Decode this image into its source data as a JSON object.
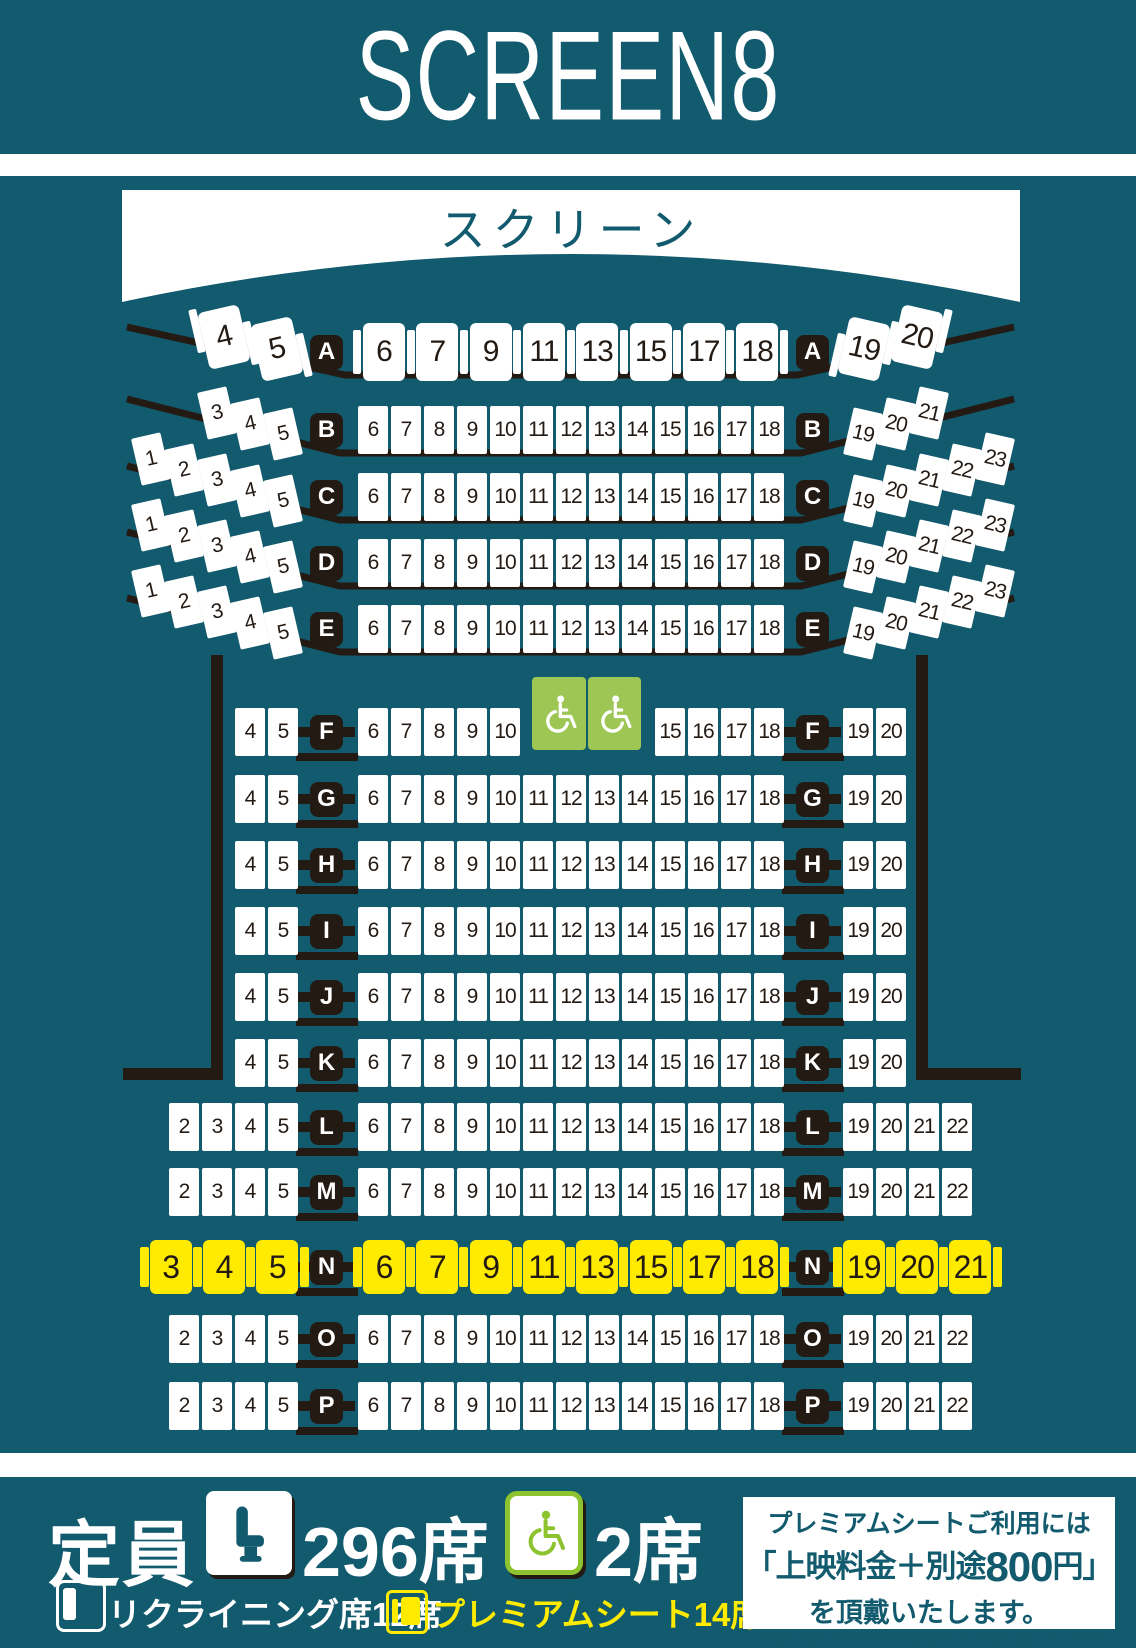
{
  "header": {
    "title": "SCREEN8"
  },
  "screen": {
    "label": "スクリーン"
  },
  "colors": {
    "background_teal": "#125a6d",
    "seat_white": "#ffffff",
    "ink_black": "#241a14",
    "premium_yellow": "#ffeb00",
    "wheelchair_green": "#9dc655",
    "legend_green": "#8cc32f"
  },
  "seatmap": {
    "rows": [
      {
        "label": "A",
        "kind": "recliner",
        "left": [
          "4",
          "5"
        ],
        "center": [
          "6",
          "7",
          "9",
          "11",
          "13",
          "15",
          "17",
          "18"
        ],
        "right": [
          "19",
          "20"
        ]
      },
      {
        "label": "B",
        "kind": "arc",
        "left": [
          "3",
          "4",
          "5"
        ],
        "center": [
          "6",
          "7",
          "8",
          "9",
          "10",
          "11",
          "12",
          "13",
          "14",
          "15",
          "16",
          "17",
          "18"
        ],
        "right": [
          "19",
          "20",
          "21"
        ]
      },
      {
        "label": "C",
        "kind": "arc",
        "left": [
          "1",
          "2",
          "3",
          "4",
          "5"
        ],
        "center": [
          "6",
          "7",
          "8",
          "9",
          "10",
          "11",
          "12",
          "13",
          "14",
          "15",
          "16",
          "17",
          "18"
        ],
        "right": [
          "19",
          "20",
          "21",
          "22",
          "23"
        ]
      },
      {
        "label": "D",
        "kind": "arc",
        "left": [
          "1",
          "2",
          "3",
          "4",
          "5"
        ],
        "center": [
          "6",
          "7",
          "8",
          "9",
          "10",
          "11",
          "12",
          "13",
          "14",
          "15",
          "16",
          "17",
          "18"
        ],
        "right": [
          "19",
          "20",
          "21",
          "22",
          "23"
        ]
      },
      {
        "label": "E",
        "kind": "arc",
        "left": [
          "1",
          "2",
          "3",
          "4",
          "5"
        ],
        "center": [
          "6",
          "7",
          "8",
          "9",
          "10",
          "11",
          "12",
          "13",
          "14",
          "15",
          "16",
          "17",
          "18"
        ],
        "right": [
          "19",
          "20",
          "21",
          "22",
          "23"
        ]
      },
      {
        "label": "F",
        "kind": "std",
        "left": [
          "4",
          "5"
        ],
        "center": [
          "6",
          "7",
          "8",
          "9",
          "10"
        ],
        "wheelchairs": 2,
        "center2": [
          "15",
          "16",
          "17",
          "18"
        ],
        "right": [
          "19",
          "20"
        ]
      },
      {
        "label": "G",
        "kind": "std",
        "left": [
          "4",
          "5"
        ],
        "center": [
          "6",
          "7",
          "8",
          "9",
          "10",
          "11",
          "12",
          "13",
          "14",
          "15",
          "16",
          "17",
          "18"
        ],
        "right": [
          "19",
          "20"
        ]
      },
      {
        "label": "H",
        "kind": "std",
        "left": [
          "4",
          "5"
        ],
        "center": [
          "6",
          "7",
          "8",
          "9",
          "10",
          "11",
          "12",
          "13",
          "14",
          "15",
          "16",
          "17",
          "18"
        ],
        "right": [
          "19",
          "20"
        ]
      },
      {
        "label": "I",
        "kind": "std",
        "left": [
          "4",
          "5"
        ],
        "center": [
          "6",
          "7",
          "8",
          "9",
          "10",
          "11",
          "12",
          "13",
          "14",
          "15",
          "16",
          "17",
          "18"
        ],
        "right": [
          "19",
          "20"
        ]
      },
      {
        "label": "J",
        "kind": "std",
        "left": [
          "4",
          "5"
        ],
        "center": [
          "6",
          "7",
          "8",
          "9",
          "10",
          "11",
          "12",
          "13",
          "14",
          "15",
          "16",
          "17",
          "18"
        ],
        "right": [
          "19",
          "20"
        ]
      },
      {
        "label": "K",
        "kind": "std",
        "left": [
          "4",
          "5"
        ],
        "center": [
          "6",
          "7",
          "8",
          "9",
          "10",
          "11",
          "12",
          "13",
          "14",
          "15",
          "16",
          "17",
          "18"
        ],
        "right": [
          "19",
          "20"
        ]
      },
      {
        "label": "L",
        "kind": "std",
        "left": [
          "2",
          "3",
          "4",
          "5"
        ],
        "center": [
          "6",
          "7",
          "8",
          "9",
          "10",
          "11",
          "12",
          "13",
          "14",
          "15",
          "16",
          "17",
          "18"
        ],
        "right": [
          "19",
          "20",
          "21",
          "22"
        ]
      },
      {
        "label": "M",
        "kind": "std",
        "left": [
          "2",
          "3",
          "4",
          "5"
        ],
        "center": [
          "6",
          "7",
          "8",
          "9",
          "10",
          "11",
          "12",
          "13",
          "14",
          "15",
          "16",
          "17",
          "18"
        ],
        "right": [
          "19",
          "20",
          "21",
          "22"
        ]
      },
      {
        "label": "N",
        "kind": "premium",
        "left": [
          "3",
          "4",
          "5"
        ],
        "center": [
          "6",
          "7",
          "9",
          "11",
          "13",
          "15",
          "17",
          "18"
        ],
        "right": [
          "19",
          "20",
          "21"
        ]
      },
      {
        "label": "O",
        "kind": "std",
        "left": [
          "2",
          "3",
          "4",
          "5"
        ],
        "center": [
          "6",
          "7",
          "8",
          "9",
          "10",
          "11",
          "12",
          "13",
          "14",
          "15",
          "16",
          "17",
          "18"
        ],
        "right": [
          "19",
          "20",
          "21",
          "22"
        ]
      },
      {
        "label": "P",
        "kind": "std",
        "left": [
          "2",
          "3",
          "4",
          "5"
        ],
        "center": [
          "6",
          "7",
          "8",
          "9",
          "10",
          "11",
          "12",
          "13",
          "14",
          "15",
          "16",
          "17",
          "18"
        ],
        "right": [
          "19",
          "20",
          "21",
          "22"
        ]
      }
    ]
  },
  "legend": {
    "capacity_label": "定員",
    "capacity_value": "296席",
    "wheelchair_value": "2席",
    "recliner_label": "リクライニング席12席",
    "premium_label": "プレミアムシート14席"
  },
  "info_box": {
    "line1": "プレミアムシートご利用には",
    "line2_pre": "「上映料金＋別途",
    "line2_big": "800",
    "line2_post": "円」",
    "line3": "を頂戴いたします。",
    "note1": "※なお、係員がチケットを確認させていただく場合がございます。",
    "note2": "ご了承くださいますようお願いいたします。"
  }
}
